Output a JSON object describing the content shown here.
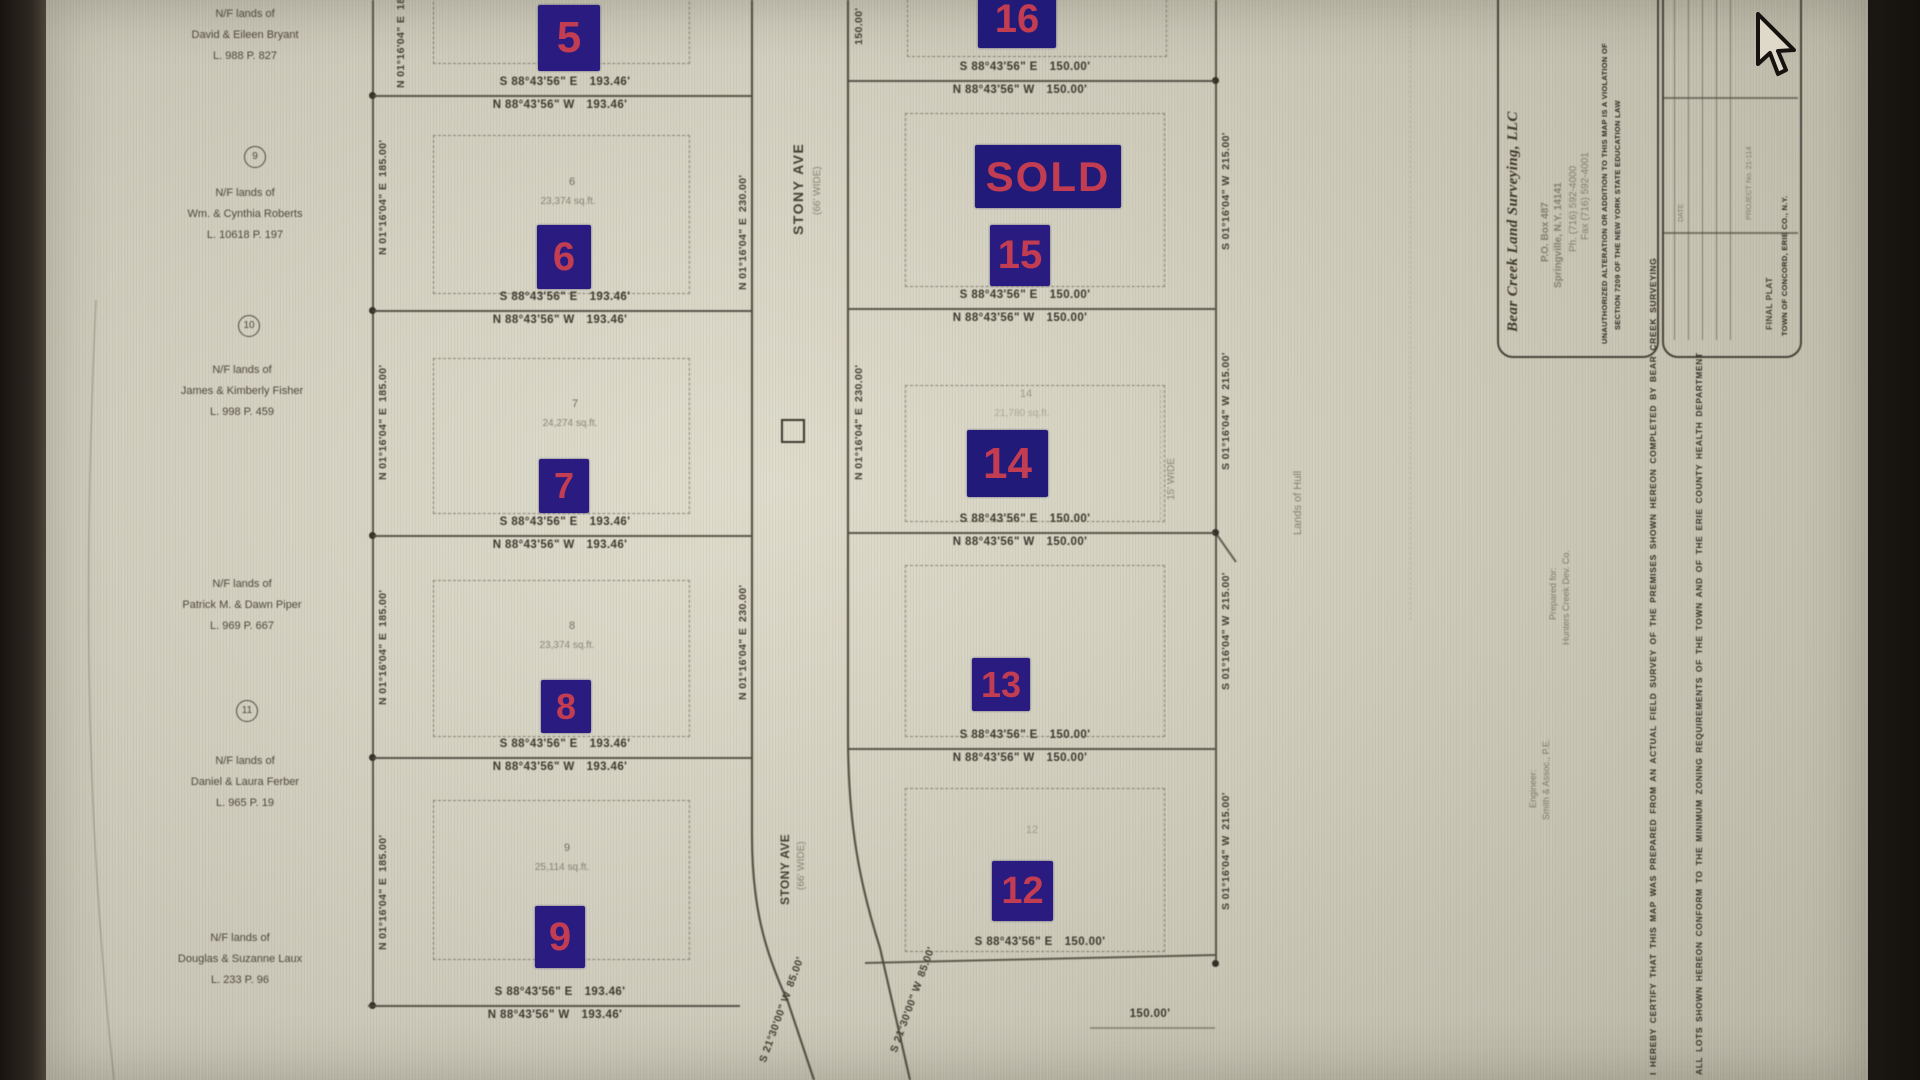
{
  "markers": [
    {
      "label": "5"
    },
    {
      "label": "6"
    },
    {
      "label": "7"
    },
    {
      "label": "8"
    },
    {
      "label": "9"
    },
    {
      "label": "16"
    },
    {
      "label": "SOLD"
    },
    {
      "label": "15"
    },
    {
      "label": "14"
    },
    {
      "label": "13"
    },
    {
      "label": "12"
    }
  ],
  "road": {
    "name": "STONY AVE",
    "width_note": "(66' WIDE)"
  },
  "bearings": {
    "left_above": "S 88°43'56\" E 193.46'",
    "left_below": "N 88°43'56\" W 193.46'",
    "right_above": "S 88°43'56\" E 150.00'",
    "right_below": "N 88°43'56\" W 150.00'",
    "west_side": "N 01°16'04\" E 185.00'",
    "east_side": "S 01°16'04\" W 215.00'",
    "road_side": "N 01°16'04\" E 230.00'",
    "curve": "S 21°30'00\" W 85.00'",
    "short_dist": "150.00'"
  },
  "lots": [
    {
      "num": "6",
      "area": "23,374 sq.ft."
    },
    {
      "num": "7",
      "area": "24,274 sq.ft."
    },
    {
      "num": "8",
      "area": "23,374 sq.ft."
    },
    {
      "num": "9",
      "area": "25,114 sq.ft."
    },
    {
      "num": "14",
      "area": "21,780 sq.ft."
    },
    {
      "num": "12",
      "area": ""
    }
  ],
  "nf_parcels": [
    {
      "line1": "N/F lands of",
      "line2": "David & Eileen Bryant",
      "line3": "L. 988 P. 827"
    },
    {
      "line1": "N/F lands of",
      "line2": "Wm. & Cynthia Roberts",
      "line3": "L. 10618 P. 197"
    },
    {
      "line1": "N/F lands of",
      "line2": "James & Kimberly Fisher",
      "line3": "L. 998 P. 459"
    },
    {
      "line1": "N/F lands of",
      "line2": "Patrick M. & Dawn Piper",
      "line3": "L. 969 P. 667"
    },
    {
      "line1": "N/F lands of",
      "line2": "Daniel & Laura Ferber",
      "line3": "L. 965 P. 19"
    },
    {
      "line1": "N/F lands of",
      "line2": "Douglas & Suzanne Laux",
      "line3": "L. 233 P. 96"
    }
  ],
  "circled_refs": [
    "9",
    "10",
    "11"
  ],
  "easement_note": "15' WIDE",
  "lands_of_note": "Lands of Hull",
  "title_block": {
    "company": "Bear Creek Land Surveying, LLC",
    "address": "P.O. Box 487",
    "city": "Springville, N.Y. 14141",
    "phone": "Ph. (716) 592-4000",
    "fax": "Fax (716) 592-4001",
    "cert1": "UNAUTHORIZED ALTERATION OR ADDITION TO THIS MAP IS A VIOLATION OF",
    "cert2": "SECTION 7209 OF THE NEW YORK STATE EDUCATION LAW",
    "project": "FINAL PLAT",
    "location": "TOWN OF CONCORD, ERIE CO., N.Y.",
    "table_label": "DATE",
    "table_note": "PROJECT No. 21-114"
  },
  "margin_notes": {
    "note1": "I HEREBY CERTIFY THAT THIS MAP WAS PREPARED FROM AN ACTUAL FIELD SURVEY OF THE PREMISES SHOWN HEREON COMPLETED BY BEAR CREEK SURVEYING",
    "note2": "ALL LOTS SHOWN HEREON CONFORM TO THE MINIMUM ZONING REQUIREMENTS OF THE TOWN AND OF THE ERIE COUNTY HEALTH DEPARTMENT",
    "prepared": "Prepared for:",
    "owner": "Hunters Creek Dev. Co.",
    "engineer": "Engineer:",
    "engineer2": "Smith & Assoc., P.E."
  },
  "colors": {
    "marker_bg": "#2a1b80",
    "marker_text": "#c23c52",
    "paper": "#d8d5c4",
    "ink": "#4b463b"
  }
}
